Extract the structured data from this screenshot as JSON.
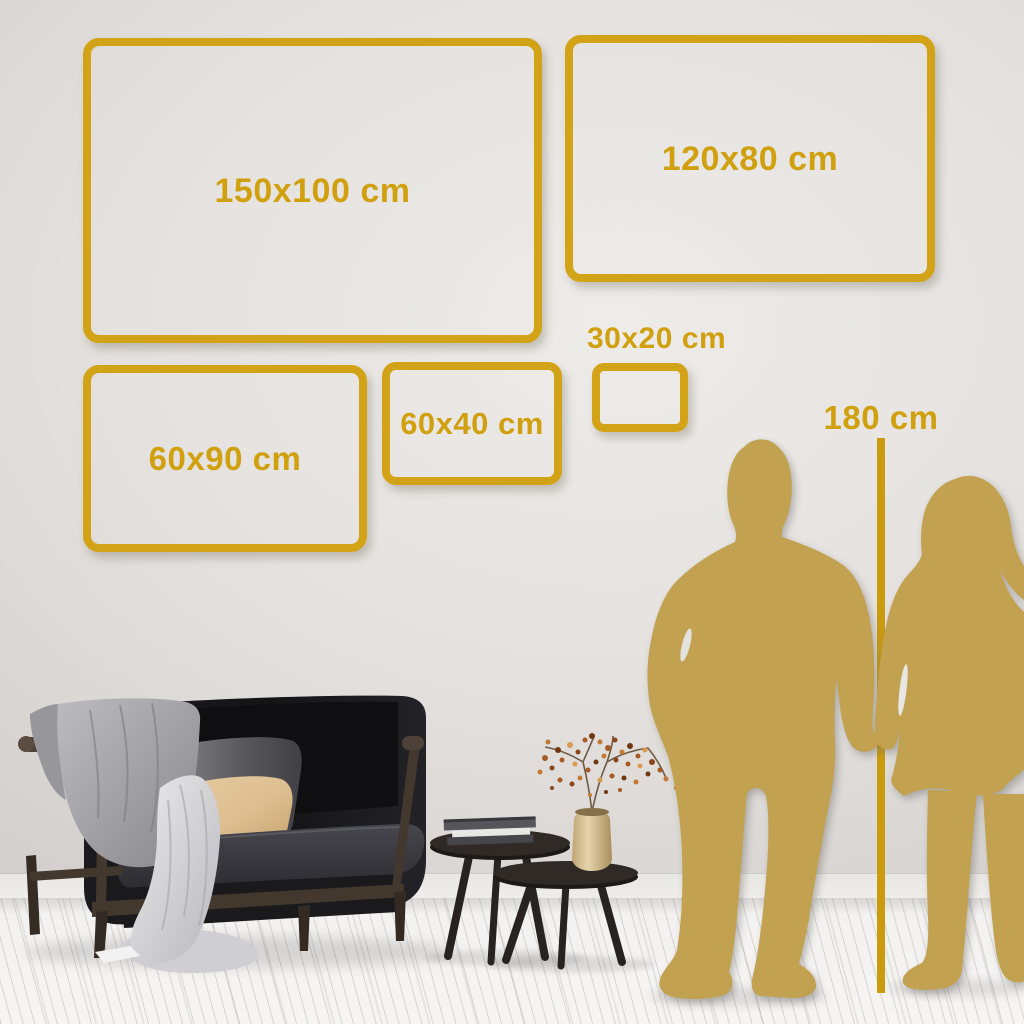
{
  "page": {
    "title": "Wall art size comparison guide",
    "unit": "cm"
  },
  "colors": {
    "accent_gold": "#D3A317",
    "silhouette_gold": "#C2A150",
    "wall": "#E4E1DE",
    "floor": "#F2F1EF"
  },
  "size_options": [
    {
      "label": "150x100 cm",
      "width_cm": 150,
      "height_cm": 100
    },
    {
      "label": "120x80 cm",
      "width_cm": 120,
      "height_cm": 80
    },
    {
      "label": "60x90 cm",
      "width_cm": 60,
      "height_cm": 90
    },
    {
      "label": "60x40 cm",
      "width_cm": 60,
      "height_cm": 40
    },
    {
      "label": "30x20 cm",
      "width_cm": 30,
      "height_cm": 20
    }
  ],
  "height_reference": {
    "label": "180 cm",
    "height_cm": 180
  },
  "scene": {
    "description": "Living room with dark velvet sofa, draped blankets, pillows, two round coffee tables with books and a brass vase holding a dried berry branch; gold silhouettes of a man and woman holding hands serve as a height reference",
    "objects": [
      "sofa",
      "gray-blanket",
      "white-throw",
      "gray-pillow",
      "tan-pillow",
      "coffee-table-large",
      "coffee-table-small",
      "books",
      "brass-vase",
      "dried-branch",
      "man-silhouette",
      "woman-silhouette"
    ]
  }
}
